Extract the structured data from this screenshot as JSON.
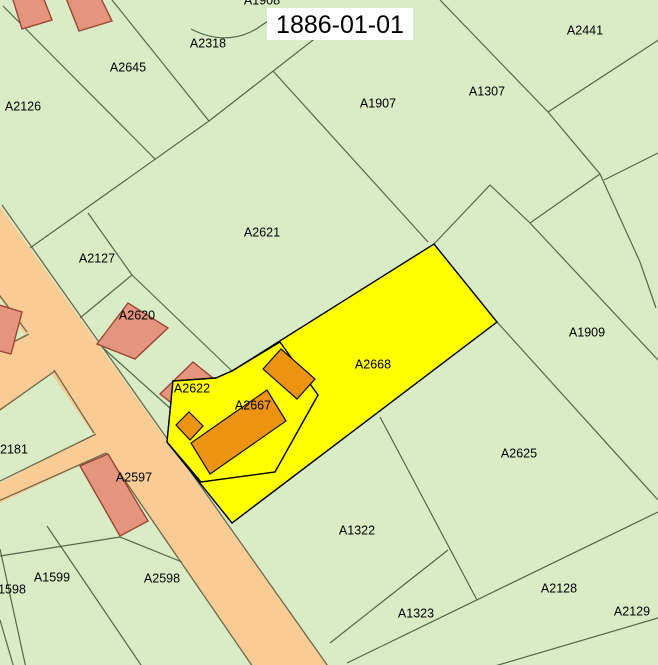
{
  "map": {
    "title": "1886-01-01",
    "highlighted_parcels": [
      "A2668",
      "A2667"
    ],
    "colors": {
      "background": "#d9ecc6",
      "parcel_line": "#51694a",
      "road_fill": "#f8cc94",
      "road_edge": "#70684a",
      "highlight_fill": "#ffff00",
      "highlight_edge": "#000000",
      "building_orange_fill": "#ee930f",
      "building_orange_edge": "#111111",
      "building_red_fill": "#e5957e",
      "building_red_edge": "#9a4634",
      "label_color": "#000000",
      "title_background": "#ffffff"
    },
    "parcel_labels": [
      {
        "id": "A1908",
        "text": "A1908",
        "x": 262,
        "y": 1
      },
      {
        "id": "A2318",
        "text": "A2318",
        "x": 208,
        "y": 44
      },
      {
        "id": "A2645",
        "text": "A2645",
        "x": 128,
        "y": 68
      },
      {
        "id": "A2126",
        "text": "A2126",
        "x": 23,
        "y": 107
      },
      {
        "id": "A2441",
        "text": "A2441",
        "x": 585,
        "y": 31
      },
      {
        "id": "A1307",
        "text": "A1307",
        "x": 487,
        "y": 92
      },
      {
        "id": "A1907",
        "text": "A1907",
        "x": 378,
        "y": 104
      },
      {
        "id": "A2621",
        "text": "A2621",
        "x": 262,
        "y": 233
      },
      {
        "id": "A2127",
        "text": "A2127",
        "x": 97,
        "y": 259
      },
      {
        "id": "A2620",
        "text": "A2620",
        "x": 137,
        "y": 316
      },
      {
        "id": "A1909",
        "text": "A1909",
        "x": 587,
        "y": 333
      },
      {
        "id": "A2622",
        "text": "A2622",
        "x": 192,
        "y": 389
      },
      {
        "id": "A2668",
        "text": "A2668",
        "x": 373,
        "y": 365
      },
      {
        "id": "A2667",
        "text": "A2667",
        "x": 253,
        "y": 406
      },
      {
        "id": "A2181",
        "text": "2181",
        "x": 14,
        "y": 450
      },
      {
        "id": "A2597",
        "text": "A2597",
        "x": 134,
        "y": 478
      },
      {
        "id": "A2625",
        "text": "A2625",
        "x": 519,
        "y": 454
      },
      {
        "id": "A1322",
        "text": "A1322",
        "x": 357,
        "y": 531
      },
      {
        "id": "A1599",
        "text": "A1599",
        "x": 52,
        "y": 578
      },
      {
        "id": "A1598",
        "text": "1598",
        "x": 12,
        "y": 590
      },
      {
        "id": "A2598",
        "text": "A2598",
        "x": 162,
        "y": 579
      },
      {
        "id": "A2128",
        "text": "A2128",
        "x": 559,
        "y": 589
      },
      {
        "id": "A1323",
        "text": "A1323",
        "x": 416,
        "y": 614
      },
      {
        "id": "A2129",
        "text": "A2129",
        "x": 632,
        "y": 612
      }
    ]
  }
}
